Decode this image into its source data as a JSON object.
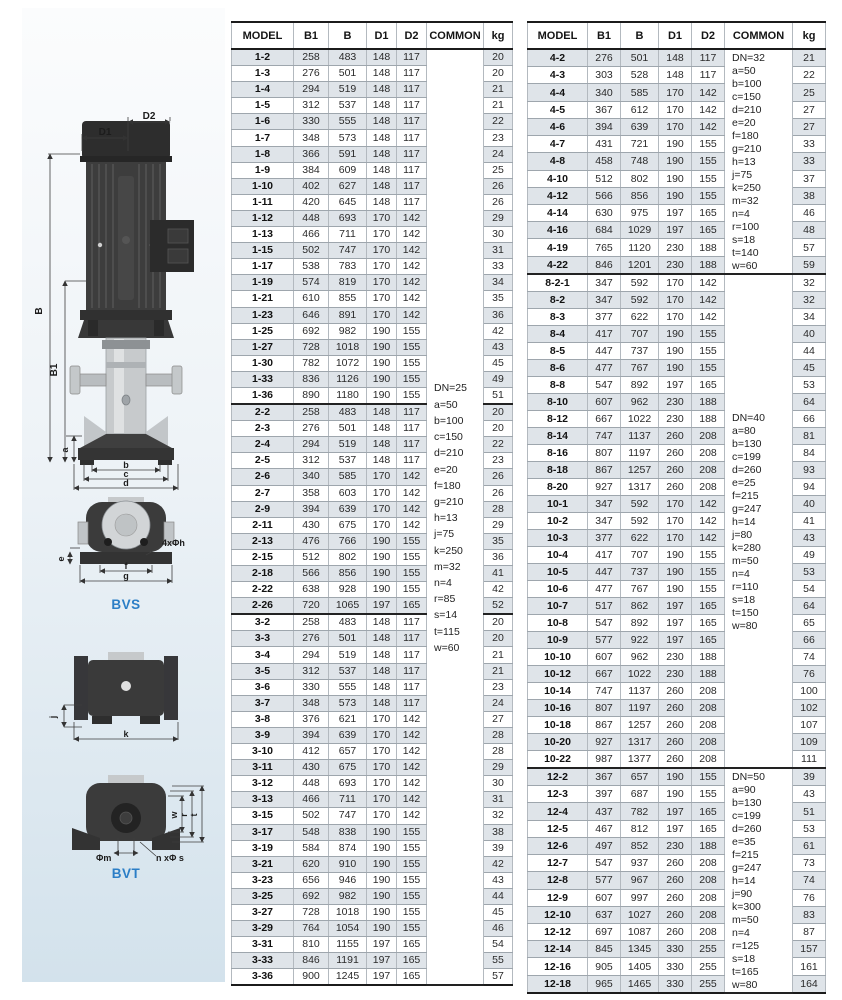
{
  "colors": {
    "caption_blue": "#2b7ec6",
    "row_shade": "#dfe4e9",
    "panel_gradient_bottom": "#d3e2ec"
  },
  "diagram": {
    "captions": {
      "bvs": "BVS",
      "bvt": "BVT"
    },
    "labels": {
      "d1": "D1",
      "d2": "D2",
      "b_total": "B",
      "b1": "B1",
      "a": "a",
      "b": "b",
      "c": "c",
      "d": "d",
      "e": "e",
      "bolt_top": "4xΦh",
      "f": "f",
      "g": "g",
      "j": "j",
      "k": "k",
      "phi_m": "Φm",
      "bolt_bottom": "n xΦ s",
      "w": "w",
      "r": "r",
      "t": "t"
    }
  },
  "tables": [
    {
      "id": "left",
      "headers": [
        "MODEL",
        "B1",
        "B",
        "D1",
        "D2",
        "COMMON",
        "kg"
      ],
      "col_widths": [
        62,
        35,
        38,
        30,
        30,
        57,
        29
      ],
      "heavy_after": [
        0,
        1
      ],
      "sections": [
        {
          "rows": [
            [
              "1-2",
              258,
              483,
              148,
              117,
              20
            ],
            [
              "1-3",
              276,
              501,
              148,
              117,
              20
            ],
            [
              "1-4",
              294,
              519,
              148,
              117,
              21
            ],
            [
              "1-5",
              312,
              537,
              148,
              117,
              21
            ],
            [
              "1-6",
              330,
              555,
              148,
              117,
              22
            ],
            [
              "1-7",
              348,
              573,
              148,
              117,
              23
            ],
            [
              "1-8",
              366,
              591,
              148,
              117,
              24
            ],
            [
              "1-9",
              384,
              609,
              148,
              117,
              25
            ],
            [
              "1-10",
              402,
              627,
              148,
              117,
              26
            ],
            [
              "1-11",
              420,
              645,
              148,
              117,
              26
            ],
            [
              "1-12",
              448,
              693,
              170,
              142,
              29
            ],
            [
              "1-13",
              466,
              711,
              170,
              142,
              30
            ],
            [
              "1-15",
              502,
              747,
              170,
              142,
              31
            ],
            [
              "1-17",
              538,
              783,
              170,
              142,
              33
            ],
            [
              "1-19",
              574,
              819,
              170,
              142,
              34
            ],
            [
              "1-21",
              610,
              855,
              170,
              142,
              35
            ],
            [
              "1-23",
              646,
              891,
              170,
              142,
              36
            ],
            [
              "1-25",
              692,
              982,
              190,
              155,
              42
            ],
            [
              "1-27",
              728,
              1018,
              190,
              155,
              43
            ],
            [
              "1-30",
              782,
              1072,
              190,
              155,
              45
            ],
            [
              "1-33",
              836,
              1126,
              190,
              155,
              49
            ],
            [
              "1-36",
              890,
              1180,
              190,
              155,
              51
            ]
          ]
        },
        {
          "rows": [
            [
              "2-2",
              258,
              483,
              148,
              117,
              20
            ],
            [
              "2-3",
              276,
              501,
              148,
              117,
              20
            ],
            [
              "2-4",
              294,
              519,
              148,
              117,
              22
            ],
            [
              "2-5",
              312,
              537,
              148,
              117,
              23
            ],
            [
              "2-6",
              340,
              585,
              170,
              142,
              26
            ],
            [
              "2-7",
              358,
              603,
              170,
              142,
              26
            ],
            [
              "2-9",
              394,
              639,
              170,
              142,
              28
            ],
            [
              "2-11",
              430,
              675,
              170,
              142,
              29
            ],
            [
              "2-13",
              476,
              766,
              190,
              155,
              35
            ],
            [
              "2-15",
              512,
              802,
              190,
              155,
              36
            ],
            [
              "2-18",
              566,
              856,
              190,
              155,
              41
            ],
            [
              "2-22",
              638,
              928,
              190,
              155,
              42
            ],
            [
              "2-26",
              720,
              1065,
              197,
              165,
              52
            ]
          ]
        },
        {
          "rows": [
            [
              "3-2",
              258,
              483,
              148,
              117,
              20
            ],
            [
              "3-3",
              276,
              501,
              148,
              117,
              20
            ],
            [
              "3-4",
              294,
              519,
              148,
              117,
              21
            ],
            [
              "3-5",
              312,
              537,
              148,
              117,
              21
            ],
            [
              "3-6",
              330,
              555,
              148,
              117,
              23
            ],
            [
              "3-7",
              348,
              573,
              148,
              117,
              24
            ],
            [
              "3-8",
              376,
              621,
              170,
              142,
              27
            ],
            [
              "3-9",
              394,
              639,
              170,
              142,
              28
            ],
            [
              "3-10",
              412,
              657,
              170,
              142,
              28
            ],
            [
              "3-11",
              430,
              675,
              170,
              142,
              29
            ],
            [
              "3-12",
              448,
              693,
              170,
              142,
              30
            ],
            [
              "3-13",
              466,
              711,
              170,
              142,
              31
            ],
            [
              "3-15",
              502,
              747,
              170,
              142,
              32
            ],
            [
              "3-17",
              548,
              838,
              190,
              155,
              38
            ],
            [
              "3-19",
              584,
              874,
              190,
              155,
              39
            ],
            [
              "3-21",
              620,
              910,
              190,
              155,
              42
            ],
            [
              "3-23",
              656,
              946,
              190,
              155,
              43
            ],
            [
              "3-25",
              692,
              982,
              190,
              155,
              44
            ],
            [
              "3-27",
              728,
              1018,
              190,
              155,
              45
            ],
            [
              "3-29",
              764,
              1054,
              190,
              155,
              46
            ],
            [
              "3-31",
              810,
              1155,
              197,
              165,
              54
            ],
            [
              "3-33",
              846,
              1191,
              197,
              165,
              55
            ],
            [
              "3-36",
              900,
              1245,
              197,
              165,
              57
            ]
          ]
        }
      ],
      "common_groups": [
        {
          "sections": [
            0,
            1,
            2
          ],
          "lines": [
            "DN=25",
            "a=50",
            "b=100",
            "c=150",
            "d=210",
            "e=20",
            "f=180",
            "g=210",
            "h=13",
            "j=75",
            "k=250",
            "m=32",
            "n=4",
            "r=85",
            "s=14",
            "t=115",
            "w=60"
          ]
        }
      ]
    },
    {
      "id": "right",
      "headers": [
        "MODEL",
        "B1",
        "B",
        "D1",
        "D2",
        "COMMON",
        "kg"
      ],
      "col_widths": [
        60,
        33,
        38,
        33,
        33,
        68,
        33
      ],
      "heavy_after": [
        0,
        2
      ],
      "sections": [
        {
          "rows": [
            [
              "4-2",
              276,
              501,
              148,
              117,
              21
            ],
            [
              "4-3",
              303,
              528,
              148,
              117,
              22
            ],
            [
              "4-4",
              340,
              585,
              170,
              142,
              25
            ],
            [
              "4-5",
              367,
              612,
              170,
              142,
              27
            ],
            [
              "4-6",
              394,
              639,
              170,
              142,
              27
            ],
            [
              "4-7",
              431,
              721,
              190,
              155,
              33
            ],
            [
              "4-8",
              458,
              748,
              190,
              155,
              33
            ],
            [
              "4-10",
              512,
              802,
              190,
              155,
              37
            ],
            [
              "4-12",
              566,
              856,
              190,
              155,
              38
            ],
            [
              "4-14",
              630,
              975,
              197,
              165,
              46
            ],
            [
              "4-16",
              684,
              1029,
              197,
              165,
              48
            ],
            [
              "4-19",
              765,
              1120,
              230,
              188,
              57
            ],
            [
              "4-22",
              846,
              1201,
              230,
              188,
              59
            ]
          ]
        },
        {
          "rows": [
            [
              "8-2-1",
              347,
              592,
              170,
              142,
              32
            ],
            [
              "8-2",
              347,
              592,
              170,
              142,
              32
            ],
            [
              "8-3",
              377,
              622,
              170,
              142,
              34
            ],
            [
              "8-4",
              417,
              707,
              190,
              155,
              40
            ],
            [
              "8-5",
              447,
              737,
              190,
              155,
              44
            ],
            [
              "8-6",
              477,
              767,
              190,
              155,
              45
            ],
            [
              "8-8",
              547,
              892,
              197,
              165,
              53
            ],
            [
              "8-10",
              607,
              962,
              230,
              188,
              64
            ],
            [
              "8-12",
              667,
              1022,
              230,
              188,
              66
            ],
            [
              "8-14",
              747,
              1137,
              260,
              208,
              81
            ],
            [
              "8-16",
              807,
              1197,
              260,
              208,
              84
            ],
            [
              "8-18",
              867,
              1257,
              260,
              208,
              93
            ],
            [
              "8-20",
              927,
              1317,
              260,
              208,
              94
            ]
          ]
        },
        {
          "rows": [
            [
              "10-1",
              347,
              592,
              170,
              142,
              40
            ],
            [
              "10-2",
              347,
              592,
              170,
              142,
              41
            ],
            [
              "10-3",
              377,
              622,
              170,
              142,
              43
            ],
            [
              "10-4",
              417,
              707,
              190,
              155,
              49
            ],
            [
              "10-5",
              447,
              737,
              190,
              155,
              53
            ],
            [
              "10-6",
              477,
              767,
              190,
              155,
              54
            ],
            [
              "10-7",
              517,
              862,
              197,
              165,
              64
            ],
            [
              "10-8",
              547,
              892,
              197,
              165,
              65
            ],
            [
              "10-9",
              577,
              922,
              197,
              165,
              66
            ],
            [
              "10-10",
              607,
              962,
              230,
              188,
              74
            ],
            [
              "10-12",
              667,
              1022,
              230,
              188,
              76
            ],
            [
              "10-14",
              747,
              1137,
              260,
              208,
              100
            ],
            [
              "10-16",
              807,
              1197,
              260,
              208,
              102
            ],
            [
              "10-18",
              867,
              1257,
              260,
              208,
              107
            ],
            [
              "10-20",
              927,
              1317,
              260,
              208,
              109
            ],
            [
              "10-22",
              987,
              1377,
              260,
              208,
              111
            ]
          ]
        },
        {
          "rows": [
            [
              "12-2",
              367,
              657,
              190,
              155,
              39
            ],
            [
              "12-3",
              397,
              687,
              190,
              155,
              43
            ],
            [
              "12-4",
              437,
              782,
              197,
              165,
              51
            ],
            [
              "12-5",
              467,
              812,
              197,
              165,
              53
            ],
            [
              "12-6",
              497,
              852,
              230,
              188,
              61
            ],
            [
              "12-7",
              547,
              937,
              260,
              208,
              73
            ],
            [
              "12-8",
              577,
              967,
              260,
              208,
              74
            ],
            [
              "12-9",
              607,
              997,
              260,
              208,
              76
            ],
            [
              "12-10",
              637,
              1027,
              260,
              208,
              83
            ],
            [
              "12-12",
              697,
              1087,
              260,
              208,
              87
            ],
            [
              "12-14",
              845,
              1345,
              330,
              255,
              157
            ],
            [
              "12-16",
              905,
              1405,
              330,
              255,
              161
            ],
            [
              "12-18",
              965,
              1465,
              330,
              255,
              164
            ]
          ]
        }
      ],
      "common_groups": [
        {
          "sections": [
            0
          ],
          "lines": [
            "DN=32",
            "a=50",
            "b=100",
            "c=150",
            "d=210",
            "e=20",
            "f=180",
            "g=210",
            "h=13",
            "j=75",
            "k=250",
            "m=32",
            "n=4",
            "r=100",
            "s=18",
            "t=140",
            "w=60"
          ]
        },
        {
          "sections": [
            1,
            2
          ],
          "lines": [
            "DN=40",
            "a=80",
            "b=130",
            "c=199",
            "d=260",
            "e=25",
            "f=215",
            "g=247",
            "h=14",
            "j=80",
            "k=280",
            "m=50",
            "n=4",
            "r=110",
            "s=18",
            "t=150",
            "w=80"
          ]
        },
        {
          "sections": [
            3
          ],
          "lines": [
            "DN=50",
            "a=90",
            "b=130",
            "c=199",
            "d=260",
            "e=35",
            "f=215",
            "g=247",
            "h=14",
            "j=90",
            "k=300",
            "m=50",
            "n=4",
            "r=125",
            "s=18",
            "t=165",
            "w=80"
          ]
        }
      ]
    }
  ]
}
